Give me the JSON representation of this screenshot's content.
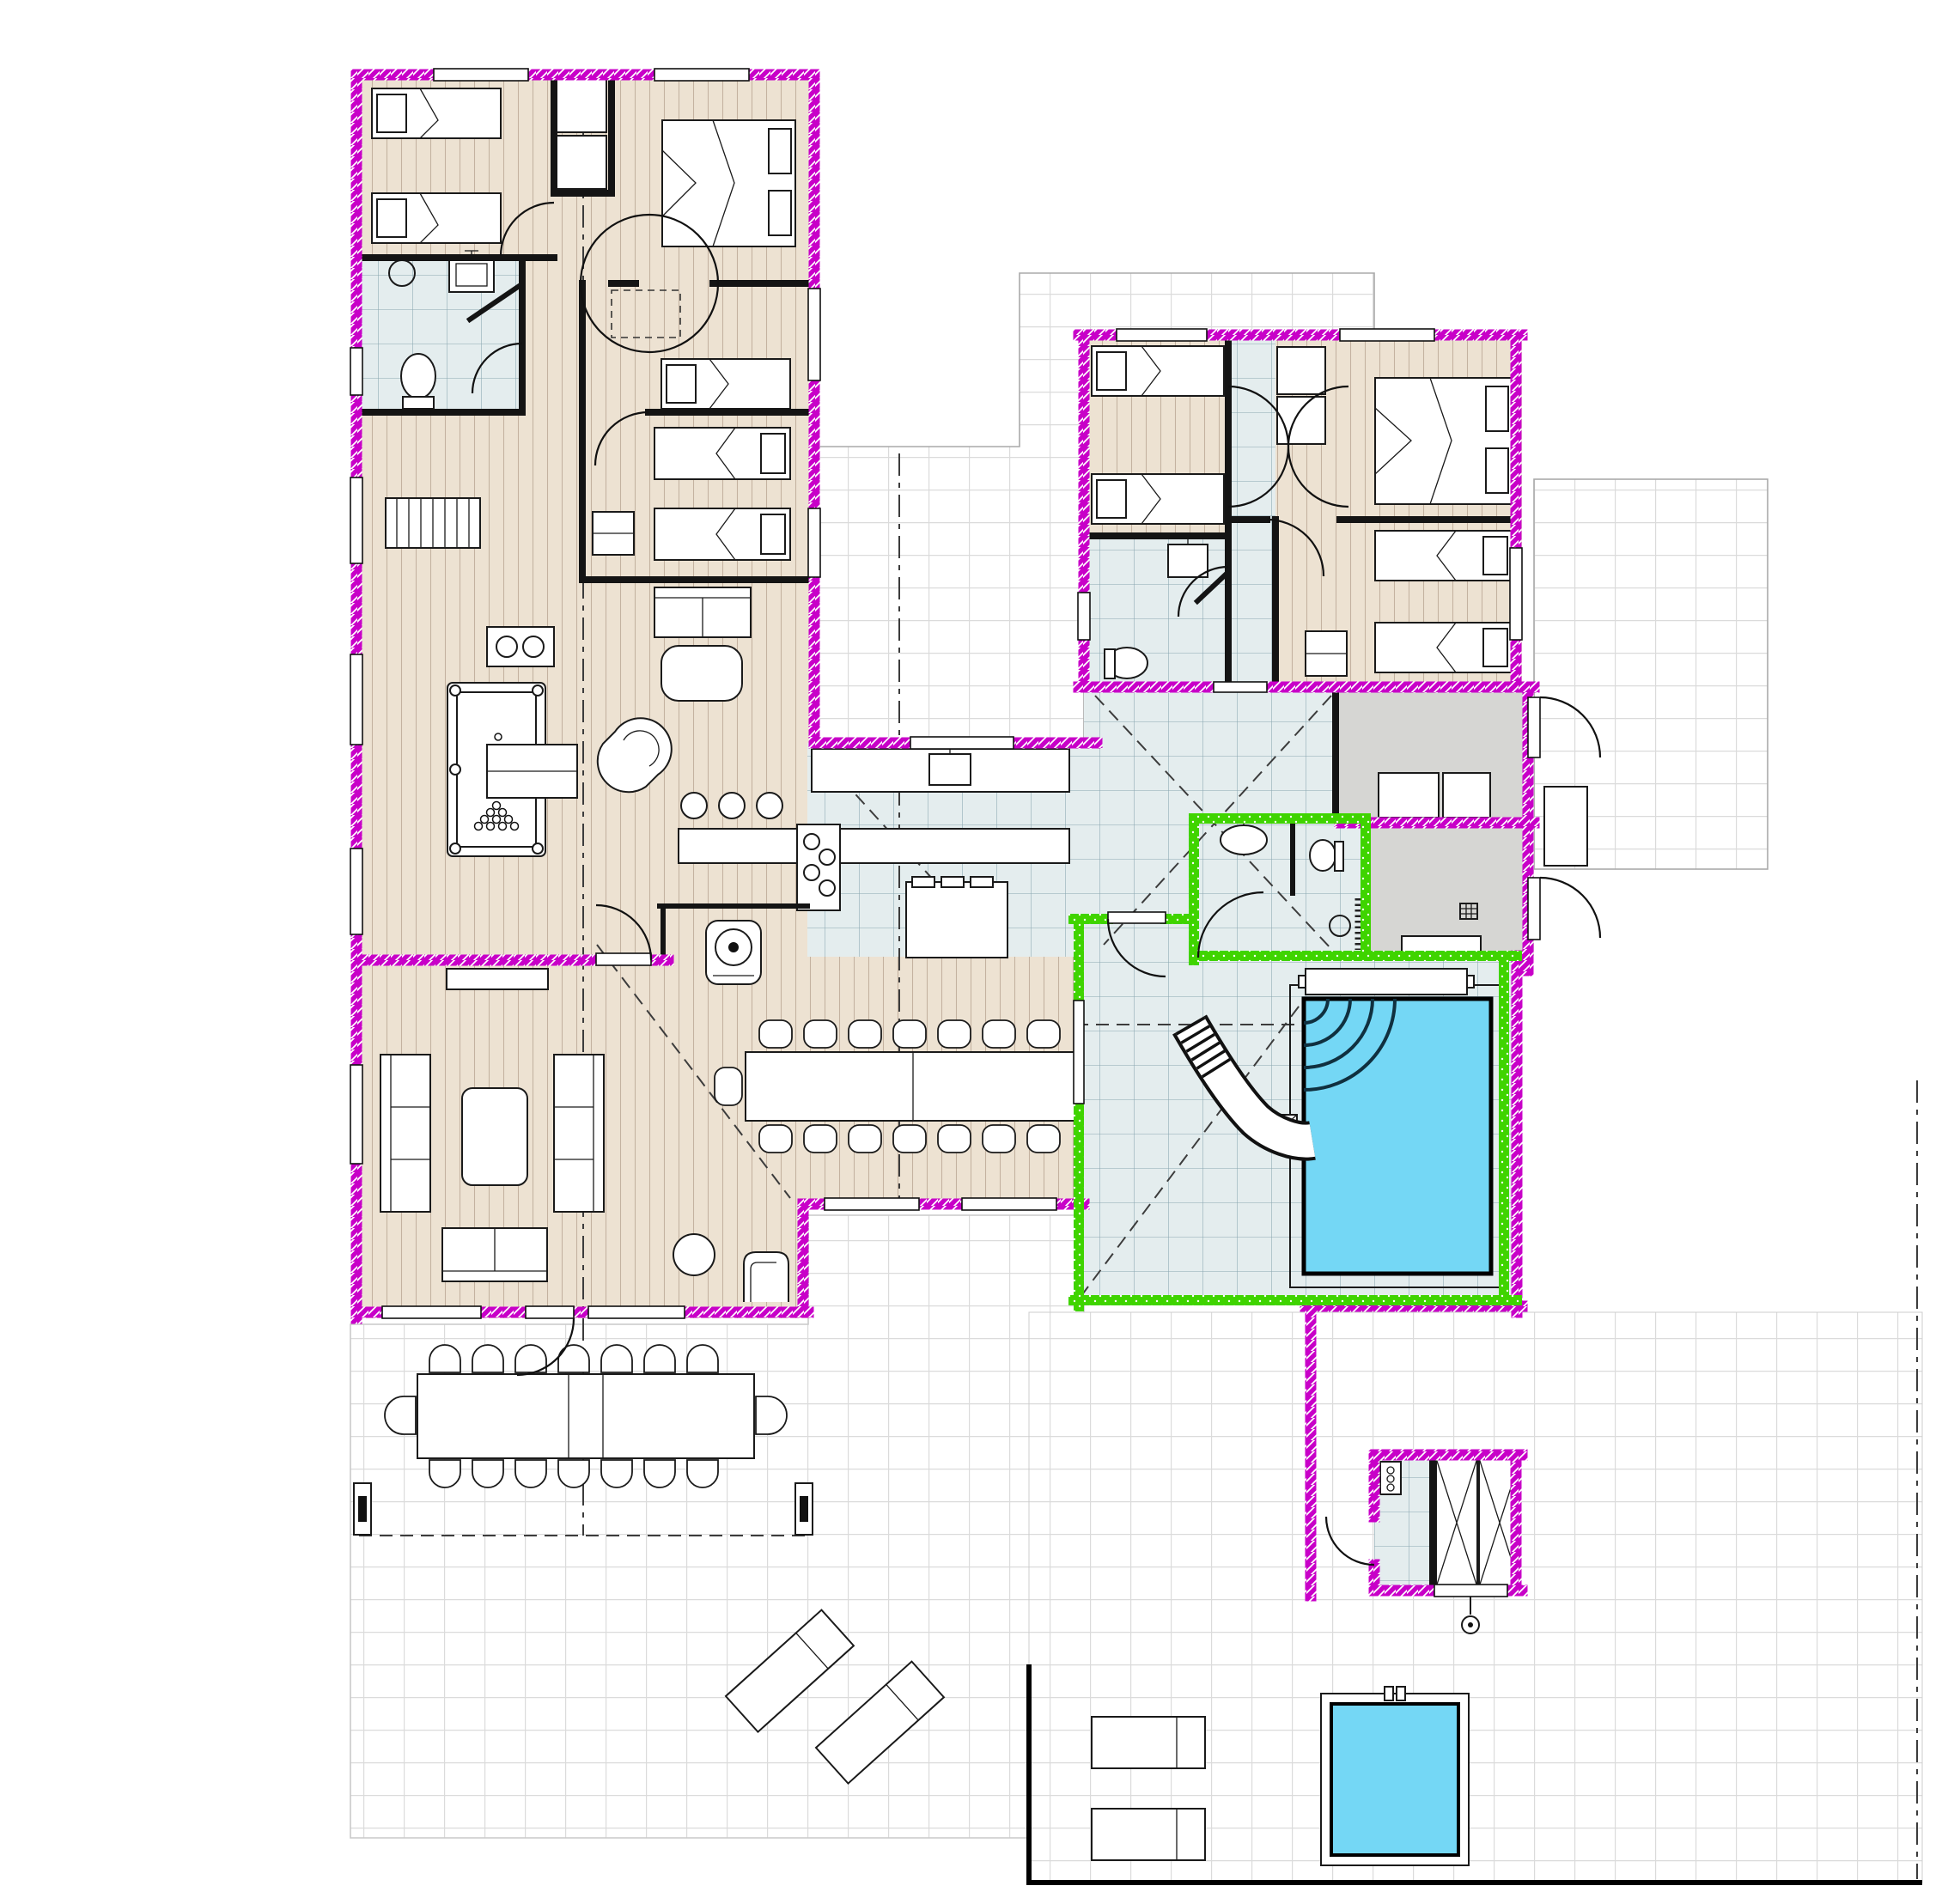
{
  "plan": {
    "kind": "architectural floor plan",
    "subject": "single-storey holiday villa with two bedroom wings, open kitchen-living area, indoor pool hall, sauna and surrounding tiled terraces",
    "colors": {
      "background": "#ffffff",
      "wall_exterior": "#C800C8",
      "wall_pool_room": "#3FD400",
      "wall_interior": "#141414",
      "wood_floor": "#EDE2D2",
      "wood_stripe": "#C4B2A0",
      "tile_floor": "#E4EDEE",
      "tile_line": "#8AA6B0",
      "terrace_tile": "#FFFFFF",
      "terrace_line": "#DBDBDB",
      "grey_floor": "#D6D6D3",
      "pool_water": "#74D7F5",
      "furniture_fill": "#FFFFFF",
      "outline": "#1A1A1A",
      "roof_dash": "#3C3C3C"
    },
    "areas": [
      {
        "name": "bedroom-1",
        "floor": "wood"
      },
      {
        "name": "bedroom-2",
        "floor": "wood"
      },
      {
        "name": "bedroom-3",
        "floor": "wood"
      },
      {
        "name": "bedroom-4",
        "floor": "wood"
      },
      {
        "name": "bathroom-west",
        "floor": "tile"
      },
      {
        "name": "entry-hall-west",
        "floor": "wood"
      },
      {
        "name": "billiard-room",
        "floor": "wood"
      },
      {
        "name": "kitchen",
        "floor": "tile"
      },
      {
        "name": "dining-area",
        "floor": "wood"
      },
      {
        "name": "lounge",
        "floor": "wood"
      },
      {
        "name": "bedroom-5",
        "floor": "wood"
      },
      {
        "name": "bedroom-6",
        "floor": "wood"
      },
      {
        "name": "bedroom-7",
        "floor": "wood"
      },
      {
        "name": "bathroom-east",
        "floor": "tile"
      },
      {
        "name": "hall-east-wing",
        "floor": "tile"
      },
      {
        "name": "entrance-hall",
        "floor": "tile"
      },
      {
        "name": "pool-bathroom",
        "floor": "tile"
      },
      {
        "name": "storage-room-1",
        "floor": "grey"
      },
      {
        "name": "storage-room-2",
        "floor": "grey"
      },
      {
        "name": "pool-hall",
        "floor": "tile"
      },
      {
        "name": "sauna",
        "floor": "wood"
      },
      {
        "name": "changing-room",
        "floor": "tile"
      },
      {
        "name": "courtyard-terrace",
        "floor": "terrace"
      },
      {
        "name": "east-terrace",
        "floor": "terrace"
      },
      {
        "name": "garden-terrace-west",
        "floor": "terrace"
      },
      {
        "name": "garden-terrace-east",
        "floor": "terrace"
      }
    ],
    "fixtures": {
      "single_beds": 8,
      "double_beds": 2,
      "cot_dashed": 1,
      "wardrobe_units": 6,
      "sofas": 4,
      "armchairs": 3,
      "billiard_table": 1,
      "coat_rack": 1,
      "fireplace_stove": 1,
      "bar_stools": 3,
      "indoor_dining_seats": 15,
      "outdoor_dining_seats": 18,
      "toilets": 3,
      "sinks": 5,
      "swimming_pool": 1,
      "water_slide": 1,
      "pool_bench": 1,
      "hot_tub": 1,
      "sun_loungers": 4,
      "sauna_heater": 1,
      "lockers": 2,
      "outdoor_shower": 1,
      "terrace_posts": 2
    }
  }
}
